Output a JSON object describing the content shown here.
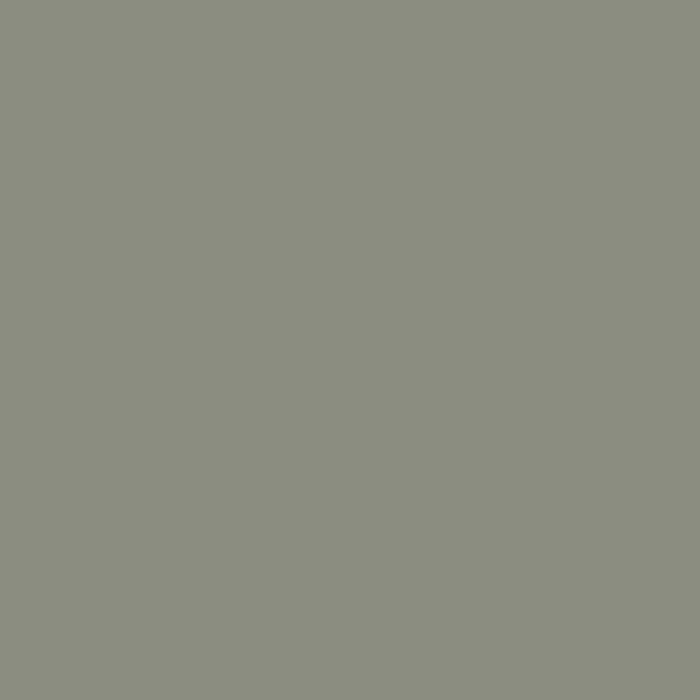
{
  "map": {
    "kind": "engraved-city-plan",
    "colors": {
      "block": "#8a8d80",
      "street": "#cbcabd",
      "ink": "#23231c",
      "church": "#3b3b33",
      "highlight": "#ffe216"
    },
    "highlight_route": "Passage du Saumon (yellow)",
    "labels": {
      "croissant": "Croissant",
      "joseph": "Joseph",
      "rue_mont_nw": "Rue",
      "rue_left_edge": "rue",
      "pierre": "Pierre",
      "du_left": "du",
      "mail": "Mail",
      "rue_neuve": "Rue",
      "neuve": "Neuve",
      "st_neuve": "St",
      "eustache": "Eustache",
      "fosses": "Fossé",
      "fosses_montmartre": "Montmartre",
      "bout_rue": "Ruë",
      "bout_au": "au",
      "bout_bout": "Bout",
      "bout_du": "du",
      "bout_monde": "Monde",
      "carreaux": "Carreaux",
      "rue_top_center": "Rue",
      "rue_top_right": "Rue",
      "rue_top_ne": "Rué",
      "ste_corner": "Ste",
      "des_ne": "des",
      "saint": "Saint",
      "bourdeaux": "Bourdeaux",
      "st_sauveur": "St. Sauveur",
      "rue_east_mid": "Rue",
      "rue_east_low": "Rue",
      "pan_fragment": "Pan...",
      "cour_des": "Cour des",
      "miracles": "Miracles",
      "montorgueil": "Montorgueil",
      "rue_tiquetonne": "Rue",
      "tiquetonne": "Tiquetonne",
      "passage": "Passage",
      "passage_du": "du",
      "saumon": "Saumon",
      "jussienne": "Jussienne",
      "rue_verdelet_upper": "Rue",
      "verdelet": "Verdelet",
      "rue_pagevin": "Rue Pagevin",
      "platriere": "Platriere",
      "du_jour": "du Jour",
      "couvent": "Couv. de Ste",
      "reposoir_line1": "R. du Pt",
      "reposoir_line2": "Reposoir",
      "place_line1": "Place",
      "place_line2": "des",
      "place_line3": "Victoires",
      "montmartre": "Montmartre",
      "comtesse": "Comtesse",
      "trainee": "Trainée"
    }
  }
}
